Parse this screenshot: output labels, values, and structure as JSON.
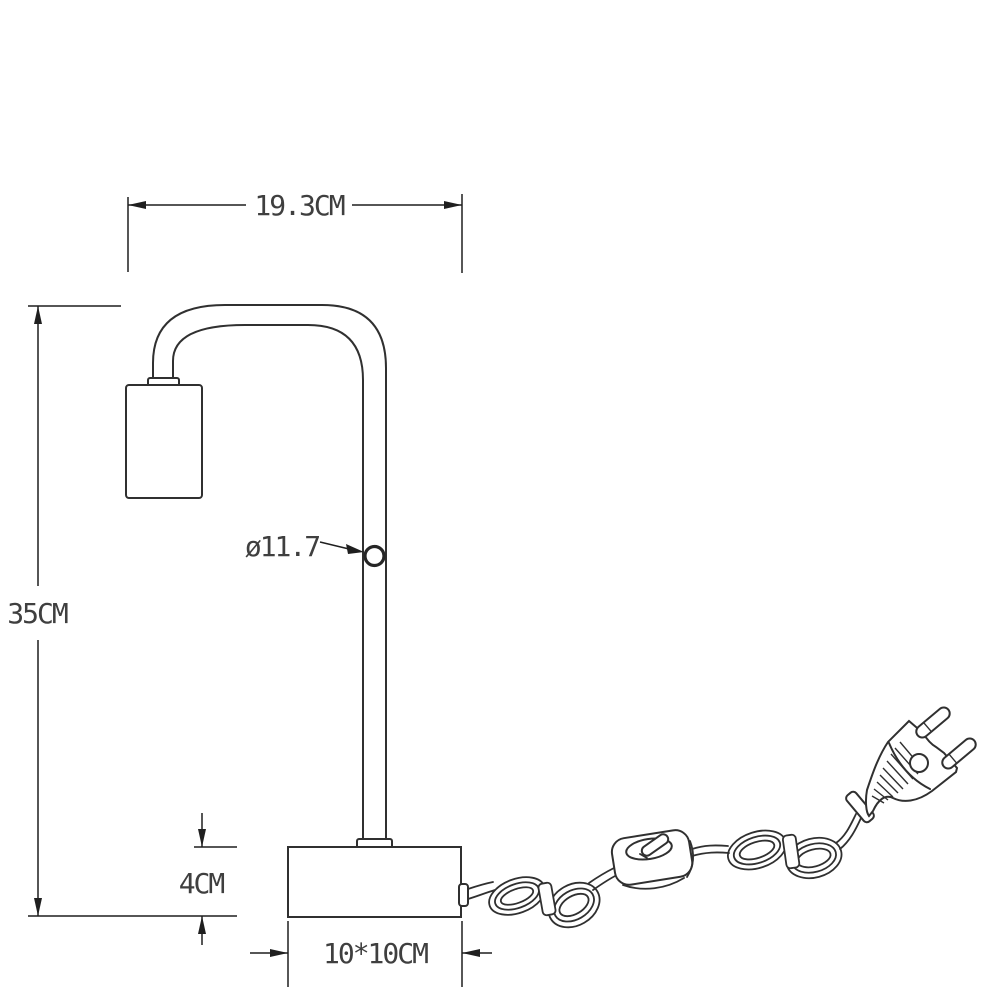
{
  "page": {
    "background": "#ffffff"
  },
  "drawing": {
    "kind": "technical-dimension-diagram",
    "subject": "table-lamp-with-cord-switch-and-plug",
    "colors": {
      "line": "#303030",
      "dimension_line": "#1f1f1f",
      "text": "#3f3f3f",
      "background": "#ffffff"
    },
    "dimensions": {
      "arm_width": {
        "label": "19.3CM"
      },
      "total_height": {
        "label": "35CM"
      },
      "tube_diameter": {
        "label": "ø11.7"
      },
      "base_height": {
        "label": "4CM"
      },
      "base_size": {
        "label": "10*10CM"
      }
    },
    "parts": [
      "lamp-head-cylinder",
      "curved-arm-tube",
      "vertical-pole",
      "ball-joint",
      "square-base",
      "power-cord",
      "cord-coil-left",
      "inline-rocker-switch",
      "cord-coil-right",
      "euro-two-pin-plug"
    ]
  }
}
